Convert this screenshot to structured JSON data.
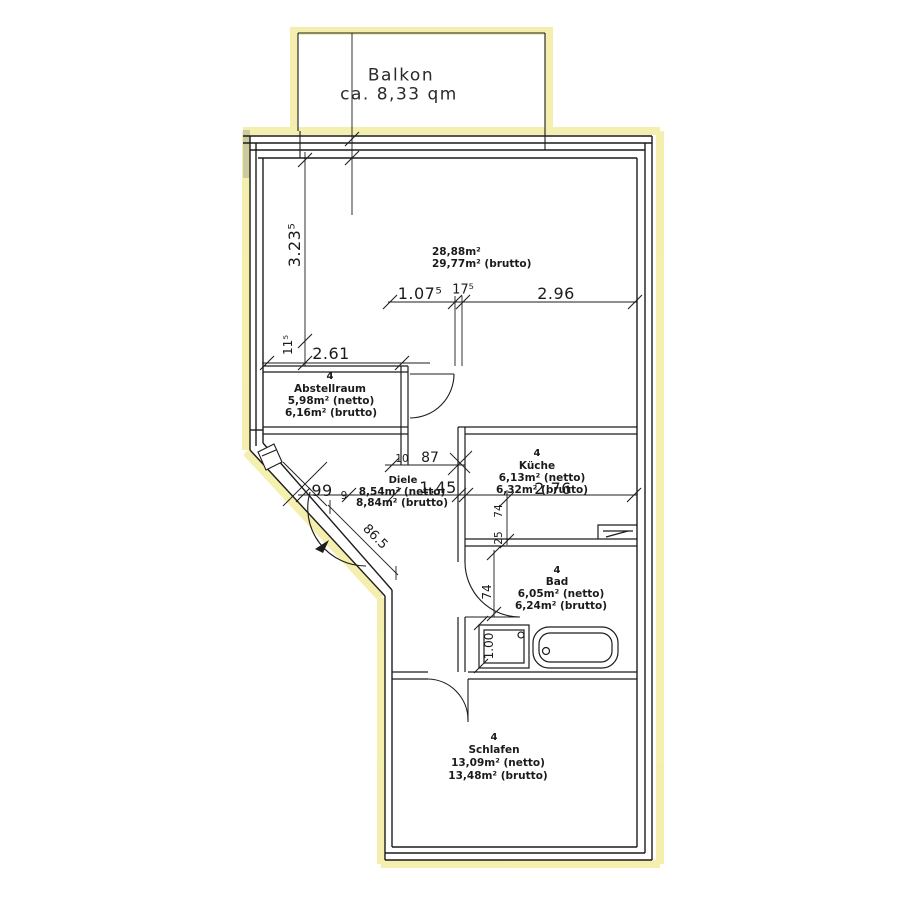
{
  "plan": {
    "balcony": {
      "label": "Balkon",
      "area": "ca. 8,33 qm"
    },
    "rooms": {
      "wohnen": {
        "area_netto": "28,88m²",
        "area_brutto": "29,77m² (brutto)"
      },
      "abstellraum": {
        "unit": "4",
        "name": "Abstellraum",
        "area_netto": "5,98m² (netto)",
        "area_brutto": "6,16m² (brutto)"
      },
      "diele": {
        "name": "Diele",
        "area_netto": "8,54m² (netto)",
        "area_brutto": "8,84m² (brutto)"
      },
      "kueche": {
        "unit": "4",
        "name": "Küche",
        "area_netto": "6,13m² (netto)",
        "area_brutto": "6,32m² (brutto)"
      },
      "bad": {
        "unit": "4",
        "name": "Bad",
        "area_netto": "6,05m² (netto)",
        "area_brutto": "6,24m² (brutto)"
      },
      "schlafen": {
        "unit": "4",
        "name": "Schlafen",
        "area_netto": "13,09m² (netto)",
        "area_brutto": "13,48m² (brutto)"
      }
    },
    "dimensions": {
      "living_height": "3.23⁵",
      "wall_thickness": "11⁵",
      "abstellraum_width": "2.61",
      "living_seg_a": "1.07⁵",
      "living_wall": "17⁵",
      "living_seg_b": "2.96",
      "diele_wall": "10",
      "diele_door": "87",
      "diele_width": "1.45",
      "entry_seg_a": "99",
      "entry_seg_b": "9",
      "entry_diagonal": "86.5",
      "kueche_width": "2.76",
      "kueche_seg_a": "74",
      "kueche_seg_b": "25",
      "bad_door": "74",
      "shower_width": "1.00"
    },
    "colors": {
      "highlighter": "#f3eda0",
      "ink": "#1c1c1c",
      "paper": "#ffffff"
    }
  }
}
